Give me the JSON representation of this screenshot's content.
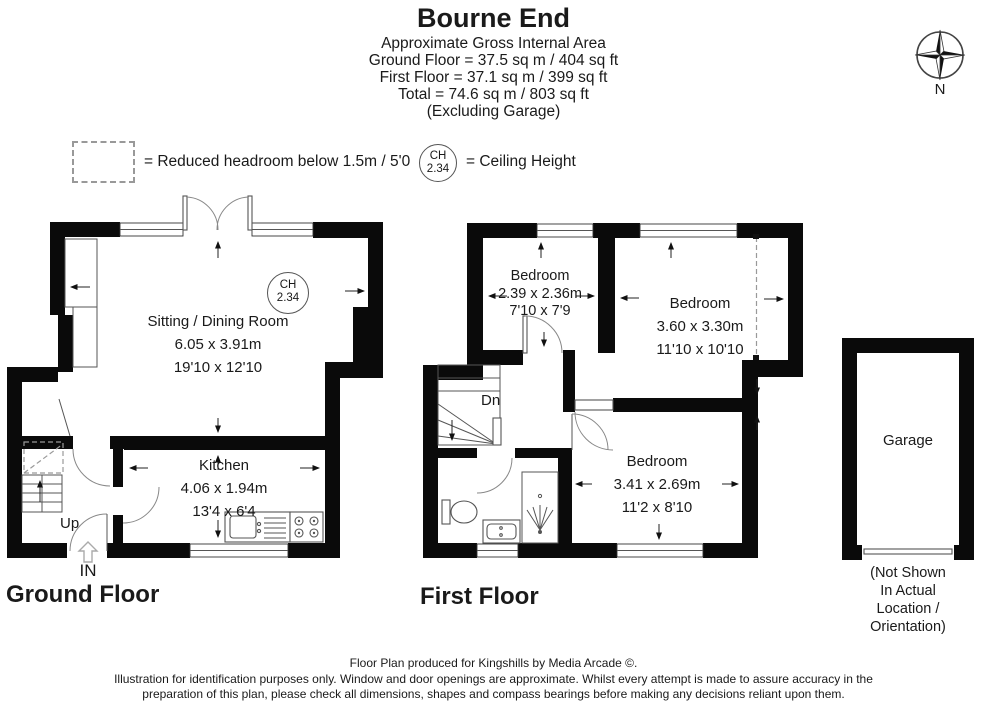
{
  "header": {
    "title": "Bourne End",
    "subtitle": "Approximate Gross Internal Area",
    "line_ground": "Ground Floor = 37.5 sq m / 404 sq ft",
    "line_first": "First Floor = 37.1 sq m / 399 sq ft",
    "line_total": "Total = 74.6 sq m / 803 sq ft",
    "line_excluding": "(Excluding Garage)"
  },
  "legend": {
    "reduced_headroom_label": "= Reduced headroom below 1.5m / 5'0",
    "ceiling_height_label": "= Ceiling Height",
    "ch_abbr": "CH",
    "ch_value": "2.34"
  },
  "compass": {
    "north_label": "N"
  },
  "ground_floor": {
    "label": "Ground Floor",
    "stairs_label": "Up",
    "entrance_label": "IN",
    "ceiling_badge": {
      "abbr": "CH",
      "value": "2.34"
    },
    "rooms": {
      "sitting_dining": {
        "name": "Sitting / Dining Room",
        "metric": "6.05 x 3.91m",
        "imperial": "19'10 x 12'10"
      },
      "kitchen": {
        "name": "Kitchen",
        "metric": "4.06 x 1.94m",
        "imperial": "13'4 x 6'4"
      }
    }
  },
  "first_floor": {
    "label": "First Floor",
    "stairs_label": "Dn",
    "rooms": {
      "bedroom_small": {
        "name": "Bedroom",
        "metric": "2.39 x 2.36m",
        "imperial": "7'10 x 7'9"
      },
      "bedroom_large": {
        "name": "Bedroom",
        "metric": "3.60 x 3.30m",
        "imperial": "11'10 x 10'10"
      },
      "bedroom_third": {
        "name": "Bedroom",
        "metric": "3.41 x 2.69m",
        "imperial": "11'2 x 8'10"
      }
    }
  },
  "garage": {
    "label": "Garage",
    "caption_line1": "(Not Shown In Actual",
    "caption_line2": "Location / Orientation)"
  },
  "footer": {
    "line1": "Floor Plan produced for Kingshills by Media Arcade ©.",
    "line2": "Illustration for identification purposes only. Window and door openings are approximate. Whilst every attempt is made to assure accuracy in the",
    "line3": "preparation of this plan, please check all dimensions, shapes and compass bearings before making any decisions reliant upon them."
  },
  "colors": {
    "wall": "#0a0a0a",
    "line": "#555555",
    "text": "#1a1a1a"
  }
}
